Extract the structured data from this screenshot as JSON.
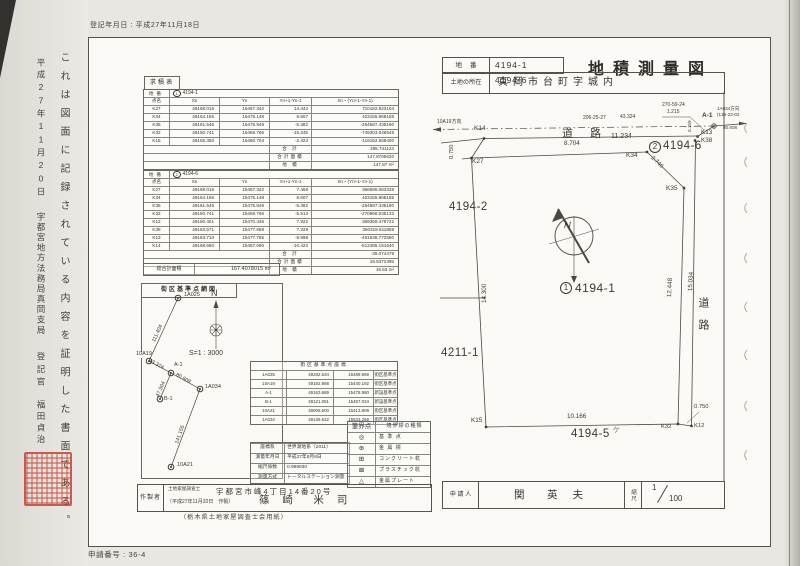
{
  "meta": {
    "registration_date": "登記年月日 : 平成27年11月18日",
    "application_number": "申請番号 : 36-4"
  },
  "margin": {
    "certificate_note": "これは図面に記録されている内容を証明した書面である。",
    "certificate_date": "平成27年11月20日",
    "registry_office": "宇都宮地方法務局真岡支局",
    "registrar_title": "登記官",
    "registrar_name": "福田貞治"
  },
  "header": {
    "lot_label": "地番",
    "lot_value": "4194-1　4194-6",
    "title": "地積測量図",
    "location_label": "土地の所在",
    "location_value": "真岡市台町字城内"
  },
  "kyuseki": {
    "section_label": "求積表",
    "headers_row": [
      [
        "点名",
        "Xn",
        "Yn",
        "Yn+1-Yn-1",
        "Xn・(Yn+1-Yn-1)"
      ]
    ],
    "table1": {
      "lot_label": "地番",
      "lot_circle": "1",
      "lot_number": "4194-1",
      "rows": [
        [
          "K27",
          "49168.016",
          "15467.342",
          "14.444",
          "710182.823104"
        ],
        [
          "K34",
          "49164.165",
          "15475.148",
          "8.607",
          "423155.968155"
        ],
        [
          "K35",
          "49161.545",
          "15475.949",
          "-5.382",
          "-264587.435190"
        ],
        [
          "K32",
          "49150.741",
          "15469.766",
          "-15.245",
          "-749303.046545"
        ],
        [
          "K15",
          "49155.350",
          "15460.704",
          "-2.424",
          "-119152.568400"
        ]
      ],
      "sum_label": "合 計",
      "sum": "295.741124",
      "half_label": "合計面積",
      "half": "147.8705620",
      "area_label": "地 積",
      "area": "147.87 m²"
    },
    "table2": {
      "lot_label": "地番",
      "lot_circle": "2",
      "lot_number": "4194-6",
      "rows": [
        [
          "K27",
          "49168.016",
          "15467.342",
          "7.458",
          "366695.063328"
        ],
        [
          "K34",
          "49164.165",
          "15475.148",
          "8.607",
          "423155.968155"
        ],
        [
          "K35",
          "49161.545",
          "15475.949",
          "-5.382",
          "-264587.435190"
        ],
        [
          "K32",
          "49150.741",
          "15469.766",
          "-5.513",
          "-270968.035133"
        ],
        [
          "K12",
          "49150.401",
          "15470.436",
          "7.922",
          "389369.476722"
        ],
        [
          "K38",
          "49163.571",
          "15477.688",
          "7.329",
          "360319.811859"
        ],
        [
          "K13",
          "49163.710",
          "15477.765",
          "-9.998",
          "-491538.772580"
        ],
        [
          "K14",
          "49168.680",
          "15467.690",
          "-10.423",
          "-512485.151640"
        ]
      ],
      "sum_label": "合 計",
      "sum": "-39.074479",
      "half_label": "合計面積",
      "half": "19.5372395",
      "area_label": "地 積",
      "area": "19.53 m²"
    },
    "grand_label": "総合計面積",
    "grand_value": "167.4078015 m²"
  },
  "network": {
    "title": "街区基準点網図",
    "north": "N",
    "scale": "S=1 : 3000",
    "nodes": {
      "n1": "1A025",
      "n2": "10A19",
      "n3": "A-1",
      "n4": "B-1",
      "n5": "1A034",
      "n6": "10A21"
    },
    "dists": {
      "d1": "111.404",
      "d2": "43.324",
      "d3": "47.504",
      "d4": "80.608",
      "d5": "141.155"
    }
  },
  "coord_table": {
    "title": "街区基準点座標",
    "rows": [
      [
        "1A025",
        "49282.634",
        "15489.959",
        "街区基準点"
      ],
      [
        "10A19",
        "49182.988",
        "15440.192",
        "街区基準点"
      ],
      [
        "A-1",
        "49163.689",
        "15478.980",
        "新設基準点"
      ],
      [
        "B-1",
        "49121.051",
        "15457.034",
        "新設基準点"
      ],
      [
        "10A21",
        "49006.600",
        "15413.809",
        "街区基準点"
      ],
      [
        "1A034",
        "49136.622",
        "15533.268",
        "街区基準点"
      ]
    ]
  },
  "survey_info": {
    "rows": [
      [
        "座標系",
        "世界測地系（2011）"
      ],
      [
        "測量年月日",
        "平成27年8月8日"
      ],
      [
        "縮尺係数",
        "0.999930"
      ],
      [
        "測量方式",
        "トータルステーション測量"
      ]
    ]
  },
  "legend": {
    "headers": [
      "筆界点",
      "境界標の種類"
    ],
    "rows": [
      [
        "◎",
        "基 準 点"
      ],
      [
        "⊕",
        "金 属 標"
      ],
      [
        "⊞",
        "コンクリート杭"
      ],
      [
        "⊠",
        "プラスチック杭"
      ],
      [
        "△",
        "金属プレート"
      ]
    ]
  },
  "author": {
    "label": "作製者",
    "qualification": "土地家屋調査士",
    "address": "宇都宮市峰4丁目14番20号",
    "made_date": "（平成27年11月20日　作製）",
    "name": "篠 崎　米 司",
    "paper_note": "（栃木県土地家屋調査士会用紙）"
  },
  "applicant": {
    "label": "申 請 人",
    "name": "関　英 夫",
    "scale_label": "縮尺",
    "scale_num": "1",
    "scale_den": "100"
  },
  "map": {
    "north": "N",
    "labels": {
      "dir_left": "10A19方向",
      "ang1": "206-25-27",
      "d1": "43.324",
      "ang2": "270-59-24",
      "d2": "1.215",
      "a1": "A-1",
      "dir_right": "1A034方向",
      "ang3": "(136-22-02",
      "d3": "80.608",
      "k14": "K14",
      "road_top": "道 路",
      "d_11234": "11.234",
      "d_0750a": "0.750",
      "k27": "K27",
      "d_8704": "8.704",
      "k34": "K34",
      "lot6_circle": "2",
      "lot6": "4194-6",
      "k13": "K13",
      "k38": "K38",
      "d_0159": "0.159",
      "d_2740": "2.740",
      "k35": "K35",
      "lot_4194_2": "4194-2",
      "lot1_circle": "1",
      "lot1": "4194-1",
      "lot_4211_1": "4211-1",
      "d_12448": "12.448",
      "d_15034": "15.034",
      "road_right": "道路",
      "d_14300": "14.300",
      "k15": "K15",
      "d_10166": "10.166",
      "k32": "K32",
      "k12": "K12",
      "d_0750b": "0.750",
      "lot_4194_5": "4194-5",
      "hand_mark": "ヶ"
    }
  }
}
